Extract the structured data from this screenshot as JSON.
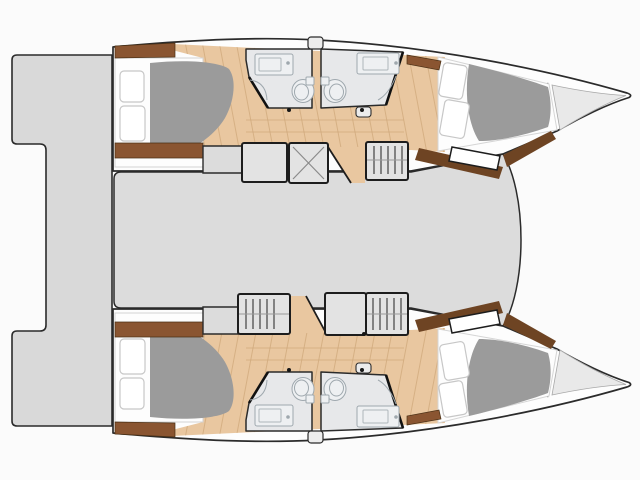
{
  "page": {
    "title": "Catamaran interior layout plan — overhead view",
    "aria_label": "Overhead floor plan of a catamaran with bow pointing right: two hulls each containing an aft double cabin, two bathrooms with toilet and vanity, companionway steps and a forward double cabin with bow locker, joined by a bridge deck and stern transom platforms",
    "background": "#fbfbfb"
  },
  "colors": {
    "background": "#fbfbfb",
    "outline": "#2b2b2b",
    "hull": "#fdfdfd",
    "deck": "#d9d9d9",
    "saloon": "#dcdcdc",
    "wood": "#e9c7a0",
    "wood_line": "#cfa87b",
    "wood_trim": "#8a5531",
    "wood_trim_dark": "#6e4423",
    "bathroom": "#e7e8ea",
    "fixture": "#9fa8ae",
    "fixture_fill": "#eef0f2",
    "duvet": "#9b9b9b",
    "mattress": "#fdfdfd",
    "pillow_edge": "#c7c7c7",
    "module": "#e3e3e3",
    "module_edge": "#1d1d1d",
    "bow_locker": "#e9e9e9",
    "hatch_x": "#8a8a8a",
    "stair_bar": "#4e4e4e",
    "door_dot": "#161616"
  },
  "plan": {
    "view": "overhead",
    "bow_direction": "right",
    "hulls": [
      {
        "name": "upper hull",
        "rooms": [
          {
            "name": "aft double cabin",
            "features": [
              "double berth",
              "two pillows",
              "gray duvet",
              "head shelf",
              "foot cabinet"
            ]
          },
          {
            "name": "aft bathroom",
            "features": [
              "vanity with sink",
              "toilet",
              "shower"
            ]
          },
          {
            "name": "forward bathroom",
            "features": [
              "vanity with sink",
              "toilet",
              "shower"
            ]
          },
          {
            "name": "companionway",
            "features": [
              "steps",
              "wood landing"
            ]
          },
          {
            "name": "forward double cabin",
            "features": [
              "double berth",
              "two pillows",
              "gray duvet",
              "angled bulkhead step"
            ]
          },
          {
            "name": "bow locker",
            "features": [
              "collision bulkhead"
            ]
          }
        ]
      },
      {
        "name": "lower hull",
        "rooms": [
          {
            "name": "aft double cabin",
            "features": [
              "double berth",
              "two pillows",
              "gray duvet",
              "head shelf",
              "foot cabinet"
            ]
          },
          {
            "name": "aft bathroom",
            "features": [
              "vanity with sink",
              "toilet",
              "shower"
            ]
          },
          {
            "name": "forward bathroom",
            "features": [
              "vanity with sink",
              "toilet",
              "shower"
            ]
          },
          {
            "name": "companionway",
            "features": [
              "steps",
              "wood landing"
            ]
          },
          {
            "name": "forward double cabin",
            "features": [
              "double berth",
              "two pillows",
              "gray duvet",
              "angled bulkhead step"
            ]
          },
          {
            "name": "bow locker",
            "features": [
              "collision bulkhead"
            ]
          }
        ]
      }
    ],
    "bridge_deck": {
      "name": "saloon / bridge deck",
      "features": [
        "storage unit",
        "hatch unit with X marking",
        "barred steps unit",
        "curved forward edge"
      ]
    },
    "stern": {
      "features": [
        "upper transom platform",
        "lower transom platform",
        "connecting aft deck"
      ]
    }
  }
}
